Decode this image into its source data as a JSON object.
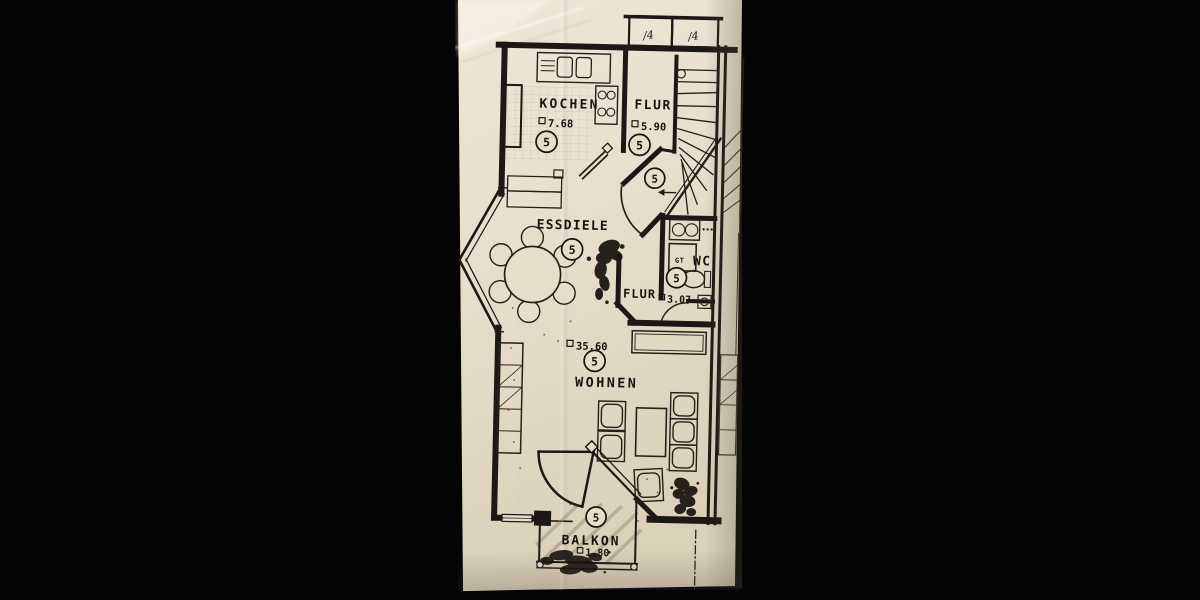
{
  "meta": {
    "type": "scanned architectural floor plan",
    "language": "de"
  },
  "scan": {
    "background_color": "#040404",
    "paper_color": "#e8dfcc",
    "ink_color": "#1d1813",
    "pencil_color": "#958a74"
  },
  "plan": {
    "unit_number": "5",
    "rooms": [
      {
        "name": "KOCHEN",
        "area": "7.68"
      },
      {
        "name": "FLUR",
        "area": "5.90"
      },
      {
        "name": "ESSDIELE",
        "area": ""
      },
      {
        "name": "FLUR",
        "area": "3.07"
      },
      {
        "name": "WC",
        "area": ""
      },
      {
        "name": "WOHNEN",
        "area": "35.60"
      },
      {
        "name": "BALKON",
        "area": "1.80"
      }
    ],
    "labels": {
      "gas_heater": "GT"
    },
    "roof_marks": [
      "/4",
      "/4"
    ]
  }
}
